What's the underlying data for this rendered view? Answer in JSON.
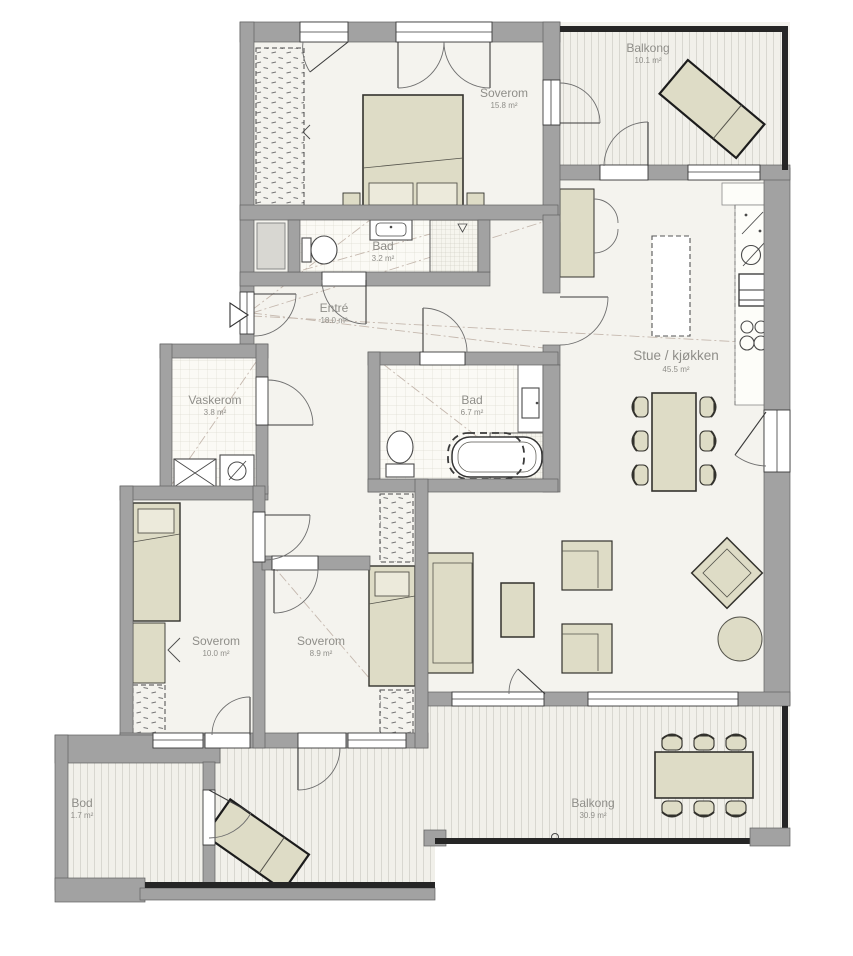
{
  "rooms": [
    {
      "id": "balkong-top",
      "name": "Balkong",
      "area": "10.1 m²"
    },
    {
      "id": "soverom-main",
      "name": "Soverom",
      "area": "15.8 m²"
    },
    {
      "id": "bad-small",
      "name": "Bad",
      "area": "3.2 m²"
    },
    {
      "id": "entre",
      "name": "Entré",
      "area": "18.0 m²"
    },
    {
      "id": "vaskerom",
      "name": "Vaskerom",
      "area": "3.8 m²"
    },
    {
      "id": "bad-large",
      "name": "Bad",
      "area": "6.7 m²"
    },
    {
      "id": "stue-kjokken",
      "name": "Stue / kjøkken",
      "area": "45.5 m²"
    },
    {
      "id": "soverom-2",
      "name": "Soverom",
      "area": "10.0 m²"
    },
    {
      "id": "soverom-3",
      "name": "Soverom",
      "area": "8.9 m²"
    },
    {
      "id": "bod",
      "name": "Bod",
      "area": "1.7 m²"
    },
    {
      "id": "balkong-bottom",
      "name": "Balkong",
      "area": "30.9 m²"
    }
  ],
  "colors": {
    "floor": "#f4f3ee",
    "tile": "#fbfaf5",
    "deck": "#f1f0ea",
    "wall": "#a2a2a2",
    "railing": "#262626",
    "furniture": "#dedcc6",
    "label_text": "#8f8e89",
    "sight_line": "#c5b8ae"
  }
}
